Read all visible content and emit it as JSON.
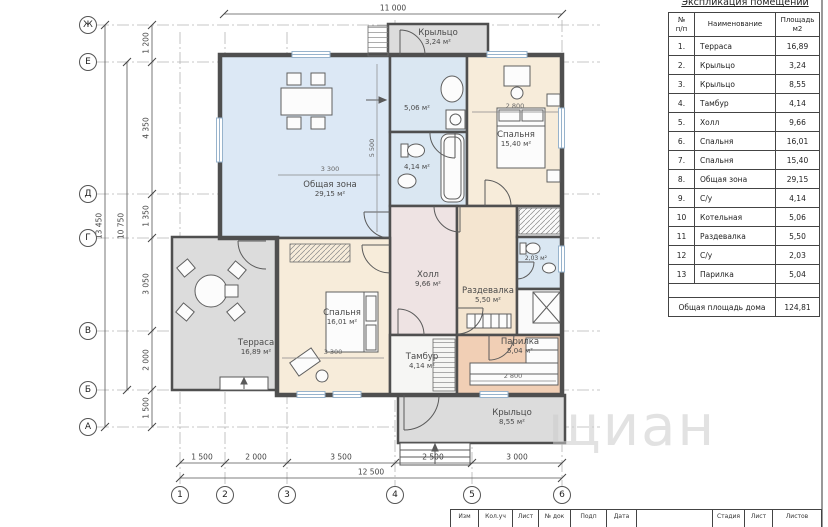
{
  "explication": {
    "title": "Экспликация помещений",
    "columns": [
      "№\nп/п",
      "Наименование",
      "Площадь\nм2"
    ],
    "rows": [
      [
        "1.",
        "Терраса",
        "16,89"
      ],
      [
        "2.",
        "Крыльцо",
        "3,24"
      ],
      [
        "3.",
        "Крыльцо",
        "8,55"
      ],
      [
        "4.",
        "Тамбур",
        "4,14"
      ],
      [
        "5.",
        "Холл",
        "9,66"
      ],
      [
        "6.",
        "Спальня",
        "16,01"
      ],
      [
        "7.",
        "Спальня",
        "15,40"
      ],
      [
        "8.",
        "Общая зона",
        "29,15"
      ],
      [
        "9.",
        "С/у",
        "4,14"
      ],
      [
        "10",
        "Котельная",
        "5,06"
      ],
      [
        "11",
        "Раздевалка",
        "5,50"
      ],
      [
        "12",
        "С/у",
        "2,03"
      ],
      [
        "13",
        "Парилка",
        "5,04"
      ]
    ],
    "total_label": "Общая площадь дома",
    "total_value": "124,81"
  },
  "plan": {
    "rooms": {
      "porch_top": {
        "name": "Крыльцо",
        "area": "3,24 м²"
      },
      "living": {
        "name": "Общая зона",
        "area": "29,15 м²"
      },
      "bedroom1": {
        "name": "Спальня",
        "area": "15,40 м²"
      },
      "boiler": {
        "area": "5,06 м²"
      },
      "wc1": {
        "area": "4,14 м²"
      },
      "hall": {
        "name": "Холл",
        "area": "9,66 м²"
      },
      "terrace": {
        "name": "Терраса",
        "area": "16,89 м²"
      },
      "bedroom2": {
        "name": "Спальня",
        "area": "16,01 м²"
      },
      "dressing": {
        "name": "Раздевалка",
        "area": "5,50 м²"
      },
      "tambour": {
        "name": "Тамбур",
        "area": "4,14 м²"
      },
      "sauna": {
        "name": "Парилка",
        "area": "5,04 м²"
      },
      "wc2": {
        "area": "2,03 м²"
      },
      "porch_bottom": {
        "name": "Крыльцо",
        "area": "8,55 м²"
      }
    },
    "axis_letters": [
      "Ж",
      "Е",
      "Д",
      "Г",
      "В",
      "Б",
      "А"
    ],
    "axis_numbers": [
      "1",
      "2",
      "3",
      "4",
      "5",
      "6"
    ],
    "dim_top": "11 000",
    "dims_bottom": [
      "1 500",
      "2 000",
      "3 500",
      "2 500",
      "3 000"
    ],
    "dim_bottom_total": "12 500",
    "dims_left": [
      "1 200",
      "4 350",
      "1 350",
      "3 050",
      "2 000",
      "1 500"
    ],
    "dim_left_sub_total": "10 750",
    "dim_left_total": "13 450",
    "dims_interior": {
      "living_w": "3 300",
      "living_h": "5 500",
      "bedroom1_w": "2 800",
      "bedroom2_w": "3 300",
      "sauna_w": "2 800"
    }
  },
  "titleblock": {
    "cells": [
      "Изм",
      "Кол.уч",
      "Лист",
      "№ док",
      "Подп",
      "Дата"
    ],
    "right_cells": [
      "Стадия",
      "Лист",
      "Листов"
    ]
  },
  "watermark": "щиан",
  "colors": {
    "living": "#dce8f5",
    "bedroom": "#f7ecda",
    "hall": "#eee3e3",
    "wet": "#dae7f2",
    "dressing": "#f4e5d0",
    "sauna": "#f1cfb5",
    "porch": "#dcdcdc",
    "tambour": "#f6f6f4",
    "closet": "#fafafa",
    "walls": "#4f4f4f"
  }
}
